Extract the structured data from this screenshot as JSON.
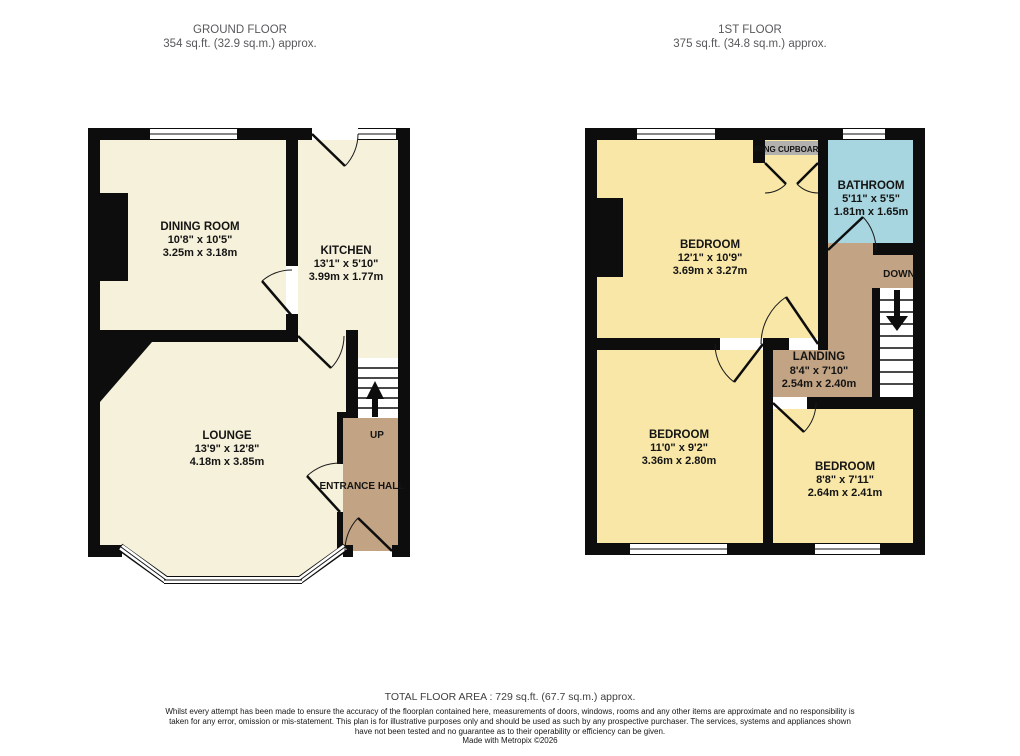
{
  "headers": {
    "ground": {
      "title": "GROUND FLOOR",
      "area": "354 sq.ft. (32.9 sq.m.) approx."
    },
    "first": {
      "title": "1ST FLOOR",
      "area": "375 sq.ft. (34.8 sq.m.) approx."
    }
  },
  "ground_floor": {
    "dining_room": {
      "name": "DINING ROOM",
      "imperial": "10'8\" x 10'5\"",
      "metric": "3.25m x 3.18m"
    },
    "kitchen": {
      "name": "KITCHEN",
      "imperial": "13'1\" x 5'10\"",
      "metric": "3.99m x 1.77m"
    },
    "lounge": {
      "name": "LOUNGE",
      "imperial": "13'9\" x 12'8\"",
      "metric": "4.18m x 3.85m"
    },
    "entrance_hall": {
      "name": "ENTRANCE HALL"
    },
    "stairs_label": "UP"
  },
  "first_floor": {
    "bedroom1": {
      "name": "BEDROOM",
      "imperial": "12'1\" x 10'9\"",
      "metric": "3.69m x 3.27m"
    },
    "bathroom": {
      "name": "BATHROOM",
      "imperial": "5'11\" x 5'5\"",
      "metric": "1.81m x 1.65m"
    },
    "landing": {
      "name": "LANDING",
      "imperial": "8'4\" x 7'10\"",
      "metric": "2.54m x 2.40m"
    },
    "bedroom2": {
      "name": "BEDROOM",
      "imperial": "11'0\" x 9'2\"",
      "metric": "3.36m x 2.80m"
    },
    "bedroom3": {
      "name": "BEDROOM",
      "imperial": "8'8\" x 7'11\"",
      "metric": "2.64m x 2.41m"
    },
    "airing_cupboard": "AIRING CUPBOARD",
    "stairs_label": "DOWN"
  },
  "footer": {
    "total_area": "TOTAL FLOOR AREA : 729 sq.ft. (67.7 sq.m.) approx.",
    "disclaimer": "Whilst every attempt has been made to ensure the accuracy of the floorplan contained here, measurements of doors, windows, rooms and any other items are approximate and no responsibility is taken for any error, omission or mis-statement. This plan is for illustrative purposes only and should be used as such by any prospective purchaser. The services, systems and appliances shown have not been tested and no guarantee as to their operability or efficiency can be given.",
    "credit": "Made with Metropix ©2026"
  },
  "colors": {
    "wall": "#0d0d0d",
    "ground_room": "#f6f1da",
    "first_room": "#f8e7a6",
    "hall": "#c2a383",
    "bathroom": "#a8d6e0",
    "cupboard_bg": "#b3b1ae"
  }
}
